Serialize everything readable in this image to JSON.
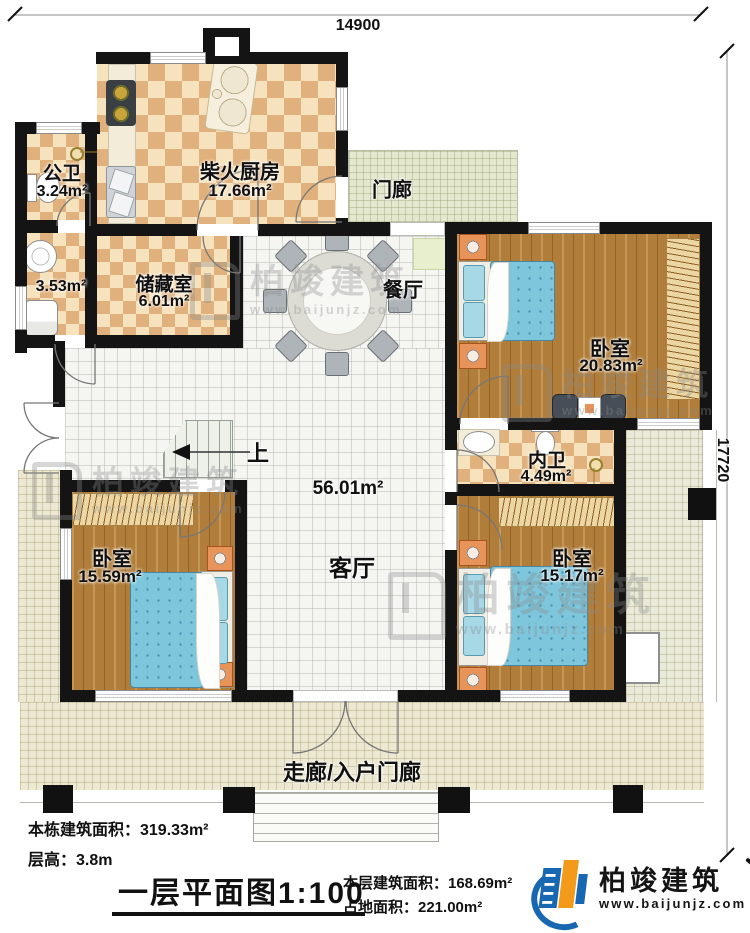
{
  "dimensions": {
    "width_label": "14900",
    "height_label": "17720"
  },
  "rooms": {
    "public_bath": {
      "name": "公卫",
      "area": "3.24m²"
    },
    "kitchen": {
      "name": "柴火厨房",
      "area": "17.66m²"
    },
    "porch": {
      "name": "门廊"
    },
    "utility": {
      "area": "3.53m²"
    },
    "storage": {
      "name": "储藏室",
      "area": "6.01m²"
    },
    "dining": {
      "name": "餐厅"
    },
    "bedroom_tr": {
      "name": "卧室",
      "area": "20.83m²"
    },
    "inner_bath": {
      "name": "内卫",
      "area": "4.49m²"
    },
    "living": {
      "name": "客厅",
      "area": "56.01m²"
    },
    "bedroom_bl": {
      "name": "卧室",
      "area": "15.59m²"
    },
    "bedroom_br": {
      "name": "卧室",
      "area": "15.17m²"
    },
    "corridor": {
      "name": "走廊/入户门廊"
    }
  },
  "stairs": {
    "up_label": "上"
  },
  "footer": {
    "building_area": "本栋建筑面积：319.33m²",
    "floor_height": "层高：3.8m",
    "title": "一层平面图",
    "scale": "1:100",
    "floor_area": "本层建筑面积：168.69m²",
    "land_area": "占地面积：221.00m²"
  },
  "brand": {
    "name": "柏竣建筑",
    "url": "www.baijunjz.com"
  },
  "watermark": {
    "name": "柏竣建筑",
    "url": "www.baijunjz.com"
  }
}
